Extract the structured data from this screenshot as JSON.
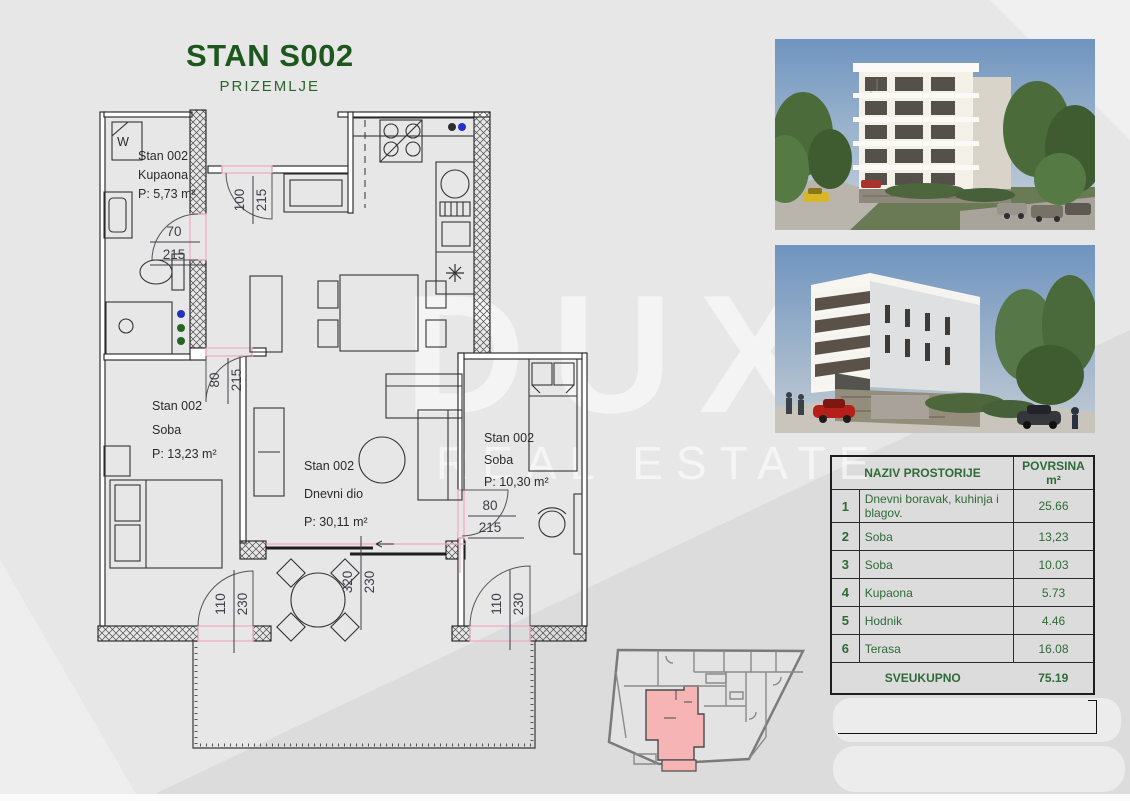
{
  "title": {
    "main": "STAN S002",
    "sub": "PRIZEMLJE"
  },
  "watermark": {
    "line1": "DUX",
    "line2": "REAL ESTATE"
  },
  "floorplan": {
    "rooms": {
      "bathroom": {
        "unit": "Stan 002",
        "name": "Kupaona",
        "area": "P: 5,73 m²"
      },
      "bedroom1": {
        "unit": "Stan 002",
        "name": "Soba",
        "area": "P: 13,23 m²"
      },
      "living": {
        "unit": "Stan 002",
        "name": "Dnevni dio",
        "area": "P: 30,11 m²"
      },
      "bedroom2": {
        "unit": "Stan 002",
        "name": "Soba",
        "area": "P: 10,30 m²"
      }
    },
    "dims": {
      "bath_door_w": "70",
      "bath_door_h": "215",
      "entry_door_w": "100",
      "entry_door_h": "215",
      "hall_door_w": "80",
      "hall_door_h": "215",
      "bedroom2_door_w": "80",
      "bedroom2_door_h": "215",
      "terrace_left_w": "110",
      "terrace_left_h": "230",
      "terrace_center_w": "320",
      "terrace_center_h": "230",
      "terrace_right_w": "110",
      "terrace_right_h": "230"
    },
    "symbols": {
      "washer": "W"
    }
  },
  "table": {
    "header": {
      "name": "NAZIV PROSTORIJE",
      "area": "POVRSINA m²"
    },
    "rows": [
      {
        "num": "1",
        "name": "Dnevni boravak, kuhinja i blagov.",
        "area": "25.66"
      },
      {
        "num": "2",
        "name": "Soba",
        "area": "13,23"
      },
      {
        "num": "3",
        "name": "Soba",
        "area": "10.03"
      },
      {
        "num": "4",
        "name": "Kupaona",
        "area": "5.73"
      },
      {
        "num": "5",
        "name": "Hodnik",
        "area": "4.46"
      },
      {
        "num": "6",
        "name": "Terasa",
        "area": "16.08"
      }
    ],
    "total": {
      "label": "SVEUKUPNO",
      "value": "75.19"
    }
  }
}
